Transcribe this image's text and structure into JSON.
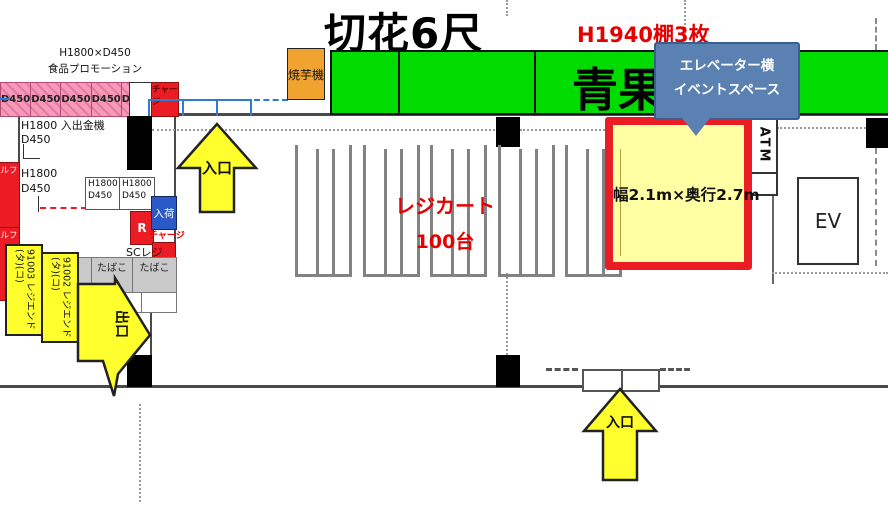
{
  "colors": {
    "green": "#00dc00",
    "pink": "#f79ab8",
    "red": "#ec1c24",
    "arrow-yellow": "#ffff2e",
    "yellow-light": "#ffffa3",
    "callout-blue": "#5b80b2",
    "orange": "#f0a32f",
    "box-blue": "#2b59c8",
    "gray-box": "#c9c9c9"
  },
  "top_strip": {
    "promo_label_line1": "H1800×D450",
    "promo_label_line2": "食品プロモーション",
    "promo_cells": [
      "D450",
      "D450",
      "D450",
      "D450",
      "D450"
    ],
    "charge_box_label": "チャージ",
    "yakiimo_label": "焼芋機",
    "kiribana_sign": "切花6尺",
    "shelf_note": "H1940棚3枚",
    "seika_sign": "青果"
  },
  "callout": {
    "line1": "エレベーター横",
    "line2": "イベントスペース"
  },
  "event_space": {
    "size_label": "幅2.1m×奥行2.7m"
  },
  "right_zone": {
    "atm_label": "ATM",
    "ev_label": "EV"
  },
  "cart_area": {
    "label_line1": "レジカート",
    "label_line2": "100台"
  },
  "arrows": {
    "top_entrance": "入口",
    "bottom_entrance": "入口",
    "exit": "出口"
  },
  "office": {
    "cash_machine_line1": "H1800 入出金機",
    "cash_machine_line2": "D450",
    "shelf2_line1": "H1800",
    "shelf2_line2": "D450",
    "small_box1_line1": "H1800",
    "small_box1_line2": "D450",
    "small_box2_line1": "H1800",
    "small_box2_line2": "D450",
    "self_label1": "セルフ",
    "self_label2": "セルフ",
    "nyuka_label": "入荷",
    "r_label": "R",
    "charge_label": "チャージ",
    "sc_reji_label": "SCレジ",
    "tabako_cells": [
      "たばこ",
      "たばこ",
      "たばこ"
    ],
    "register_labels": [
      "91003 レジエンド(タ)(コ)",
      "91002 レジエンド(タ)(コ)"
    ]
  }
}
